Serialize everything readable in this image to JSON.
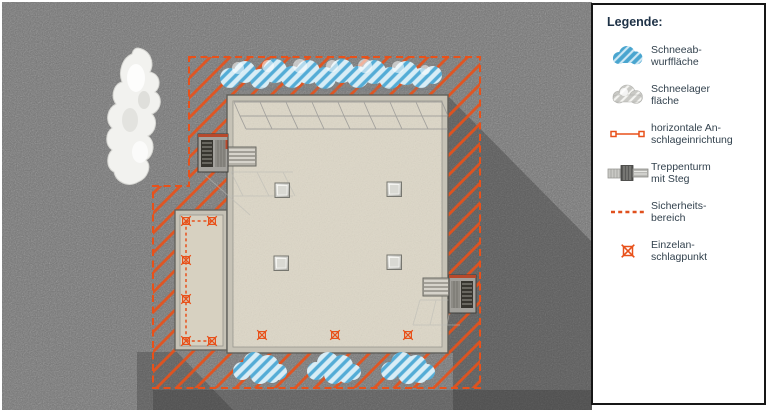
{
  "colors": {
    "asphalt": "#747474",
    "cast_shadow": "#2e2e2e",
    "safety_orange": "#e8511a",
    "roof_beige": "#ddd7c7",
    "annex_roof": "#d7d1c1",
    "parapet_gray": "#c6c2b6",
    "snow_stripe_blue": "#54acd6",
    "snow_base_blue": "#d8edf6",
    "snow_pile_white": "#f2f2ef",
    "tower_gray": "#a3a19c",
    "legend_title_color": "#1d3146",
    "legend_text_color": "#33424e"
  },
  "legend": {
    "title": "Legende:",
    "items": [
      {
        "icon": "snow-dump-area-icon",
        "label": "Schneeab-\nwurffläche"
      },
      {
        "icon": "snow-storage-area-icon",
        "label": "Schneelager\nfläche"
      },
      {
        "icon": "horizontal-anchor-icon",
        "label": "horizontale An-\nschlageinrichtung"
      },
      {
        "icon": "stair-tower-icon",
        "label": "Treppenturm\nmit Steg"
      },
      {
        "icon": "safety-zone-icon",
        "label": "Sicherheits-\nbereich"
      },
      {
        "icon": "single-anchor-point-icon",
        "label": "Einzelan-\nschlagpunkt"
      }
    ]
  },
  "diagram": {
    "single_anchor_points": {
      "main_roof": [
        [
          262,
          335
        ],
        [
          335,
          335
        ],
        [
          408,
          335
        ]
      ],
      "annex_roof": [
        [
          186,
          221
        ],
        [
          212,
          221
        ],
        [
          186,
          260
        ],
        [
          186,
          299
        ],
        [
          186,
          341
        ],
        [
          212,
          341
        ]
      ]
    },
    "anchor_connector_segments": [
      [
        [
          186,
          221
        ],
        [
          212,
          221
        ]
      ],
      [
        [
          186,
          221
        ],
        [
          186,
          341
        ]
      ],
      [
        [
          186,
          341
        ],
        [
          212,
          341
        ]
      ]
    ],
    "skylights": [
      [
        275,
        183
      ],
      [
        387,
        182
      ],
      [
        274,
        256
      ],
      [
        387,
        255
      ]
    ],
    "stair_towers": [
      {
        "position": "upper-left",
        "walkway": "onto roof from west"
      },
      {
        "position": "right",
        "walkway": "onto roof from east"
      }
    ],
    "snow_dump_areas": [
      "top band above roof",
      "bottom-left",
      "bottom-center",
      "bottom-right"
    ],
    "snow_pile_location": "outside safety zone, upper left"
  }
}
